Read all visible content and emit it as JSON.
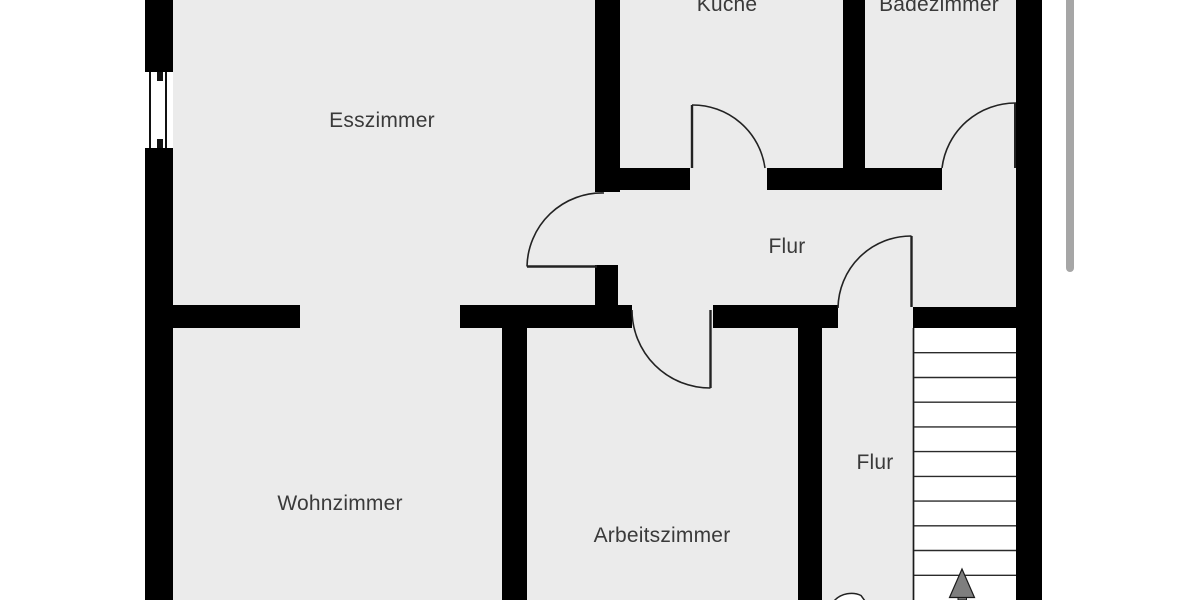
{
  "floorplan": {
    "rooms": [
      {
        "name": "Esszimmer"
      },
      {
        "name": "Küche"
      },
      {
        "name": "Badezimmer"
      },
      {
        "name": "Flur"
      },
      {
        "name": "Wohnzimmer"
      },
      {
        "name": "Arbeitszimmer"
      },
      {
        "name": "Flur"
      }
    ],
    "stairs": {
      "tread_count": 11,
      "arrow_direction": "up"
    },
    "door_count": 5,
    "window_count": 1
  },
  "colors": {
    "floor": "#ebebeb",
    "wall": "#000000",
    "line": "#222222",
    "text": "#3a3a3a",
    "arrow_fill": "#7e7e7e",
    "arrow_stroke": "#1a1a1a",
    "scrollbar": "#a6a6a6",
    "background": "#ffffff"
  }
}
